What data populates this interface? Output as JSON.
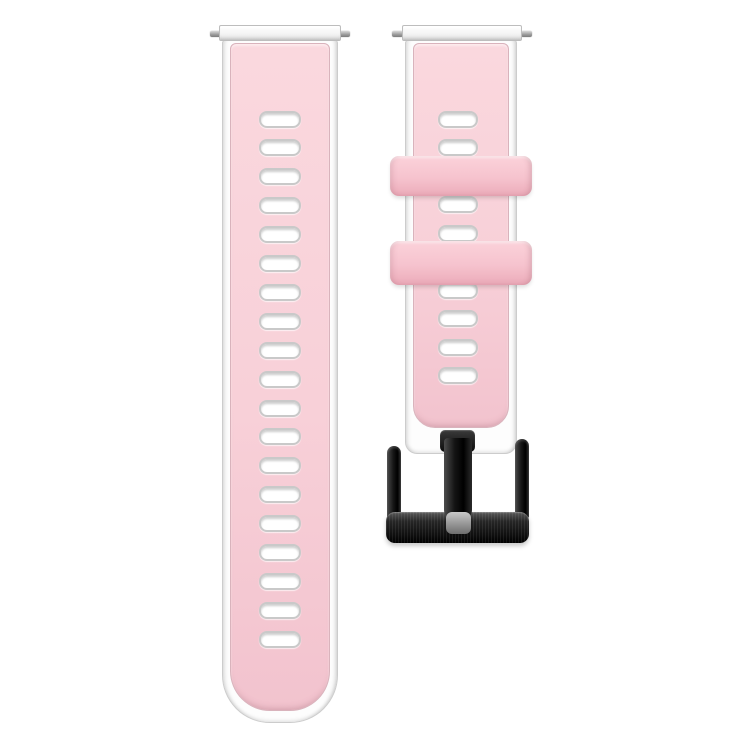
{
  "scene": {
    "background": "#ffffff",
    "subject": "two-piece silicone watch band, pink top layer over white base, black metal buckle",
    "pieces": [
      "long-tail-strap-with-ventilation-holes",
      "buckle-strap-with-two-keeper-loops"
    ]
  },
  "colors": {
    "background": "#ffffff",
    "strap_pink": "#f8d0d8",
    "strap_pink_deep": "#f2c3ce",
    "keeper_pink": "#f6c3ce",
    "pink_outline": "#d9b3bc",
    "white_layer": "#fdfdfd",
    "hole_ring": "#c9c9c9",
    "pin_gray": "#9a9a9a",
    "buckle_black": "#161616",
    "tongue_tip_gray": "#9a9a9a"
  },
  "left_strap": {
    "hole_count": 19,
    "holes": {
      "count": 19,
      "width": 42,
      "height": 17,
      "center_x": 280,
      "first_center_y": 119,
      "pitch": 28.9
    },
    "spring_bar_pins": 2
  },
  "right_strap": {
    "hole_count": 10,
    "holes": {
      "count": 10,
      "width": 40,
      "height": 17,
      "center_x": 458,
      "first_center_y": 119,
      "pitch": 28.5
    },
    "keeper_loop_count": 2,
    "spring_bar_pins": 2
  },
  "buckle": {
    "type": "pin-buckle",
    "finish": "brushed-black",
    "parts": [
      "left-arm",
      "right-arm",
      "bottom-bar",
      "tongue",
      "tongue-tip"
    ]
  }
}
